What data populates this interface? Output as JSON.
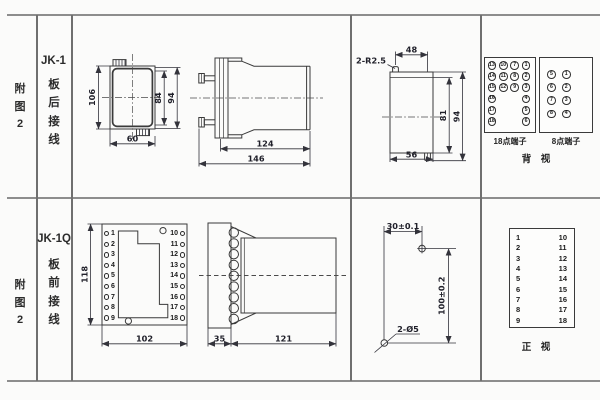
{
  "rows": [
    {
      "figure": [
        "附",
        "图",
        "2"
      ],
      "model": "JK-1",
      "wiring": [
        "板",
        "后",
        "接",
        "线"
      ]
    },
    {
      "figure": [
        "附",
        "图",
        "2"
      ],
      "model": "JK-1Q",
      "wiring": [
        "板",
        "前",
        "接",
        "线"
      ]
    }
  ],
  "jk1": {
    "front": {
      "d_height": "106",
      "d_inner": "84",
      "d_mid": "94",
      "d_width": "60"
    },
    "side": {
      "d_body": "124",
      "d_total": "146"
    },
    "cutout": {
      "note": "2-R2.5",
      "d_top": "48",
      "d_inner_h": "81",
      "d_outer_h": "94",
      "d_bottom": "56"
    }
  },
  "rear_terminals": {
    "box18": {
      "label": "18点端子",
      "col1": [
        "13",
        "14",
        "15",
        "16",
        "17",
        "18"
      ],
      "col2": [
        "10",
        "11",
        "12"
      ],
      "col3": [
        "7",
        "8",
        "9"
      ],
      "col4": [
        "1",
        "2",
        "3",
        "4",
        "5",
        "6"
      ]
    },
    "box8": {
      "label": "8点端子",
      "col1": [
        "5",
        "6",
        "7",
        "8"
      ],
      "col2": [
        "1",
        "2",
        "3",
        "4"
      ]
    },
    "view": "背　视"
  },
  "jk1q": {
    "front": {
      "d_height": "118",
      "d_width": "102",
      "left_pins": [
        "1",
        "2",
        "3",
        "4",
        "5",
        "6",
        "7",
        "8",
        "9"
      ],
      "right_pins": [
        "10",
        "11",
        "12",
        "13",
        "14",
        "15",
        "16",
        "17",
        "18"
      ]
    },
    "side": {
      "d_flange": "35",
      "d_body": "121"
    },
    "drill": {
      "d_h": "30±0.1",
      "d_v": "100±0.2",
      "holes": "2-Ø5"
    }
  },
  "front_table": {
    "left": [
      "1",
      "2",
      "3",
      "4",
      "5",
      "6",
      "7",
      "8",
      "9"
    ],
    "right": [
      "10",
      "11",
      "12",
      "13",
      "14",
      "15",
      "16",
      "17",
      "18"
    ],
    "view": "正　视"
  }
}
